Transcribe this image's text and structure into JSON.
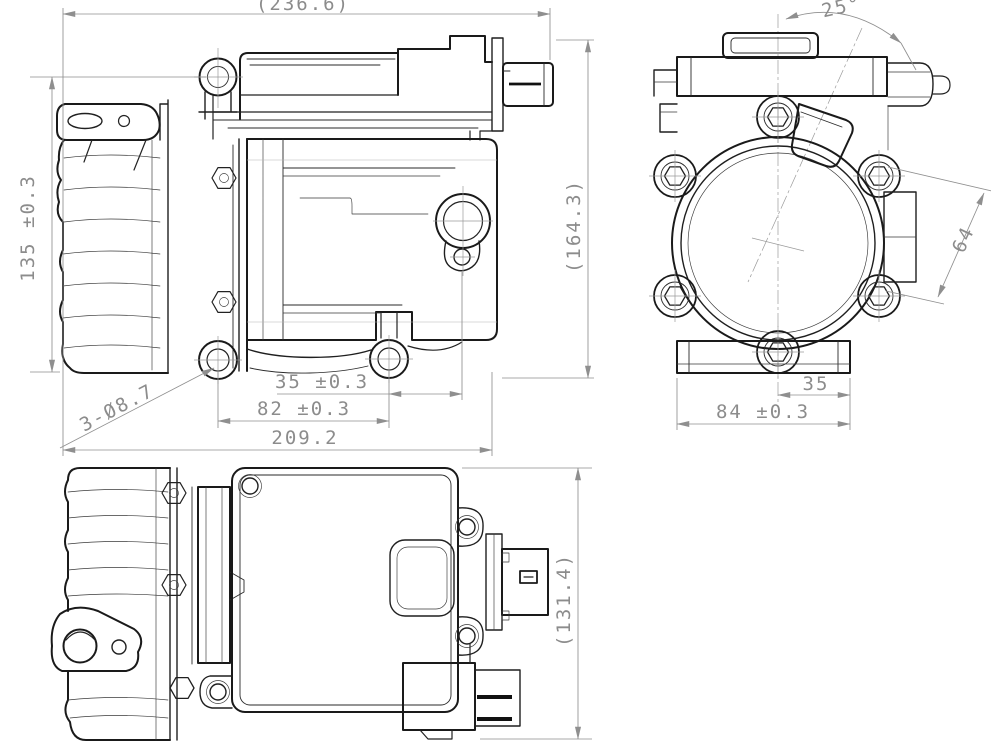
{
  "drawing": {
    "type": "engineering-three-view-drawing",
    "colors": {
      "part_line": "#1a1a1a",
      "dimension_line": "#8f8f8f",
      "background": "#ffffff"
    },
    "dimensions": {
      "side_view": {
        "overall_length": "(236.6)",
        "mount_hole_height": "135 ±0.3",
        "holes_callout": "3-Ø8.7",
        "hole_to_port": "35 ±0.3",
        "hole_spacing": "82 ±0.3",
        "base_length": "209.2",
        "overall_height": "(164.3)"
      },
      "end_view": {
        "port_angle": "25°",
        "bolt_diagonal": "64",
        "center_to_edge": "35",
        "base_width": "84 ±0.3"
      },
      "bottom_view": {
        "overall_depth": "(131.4)"
      }
    }
  }
}
